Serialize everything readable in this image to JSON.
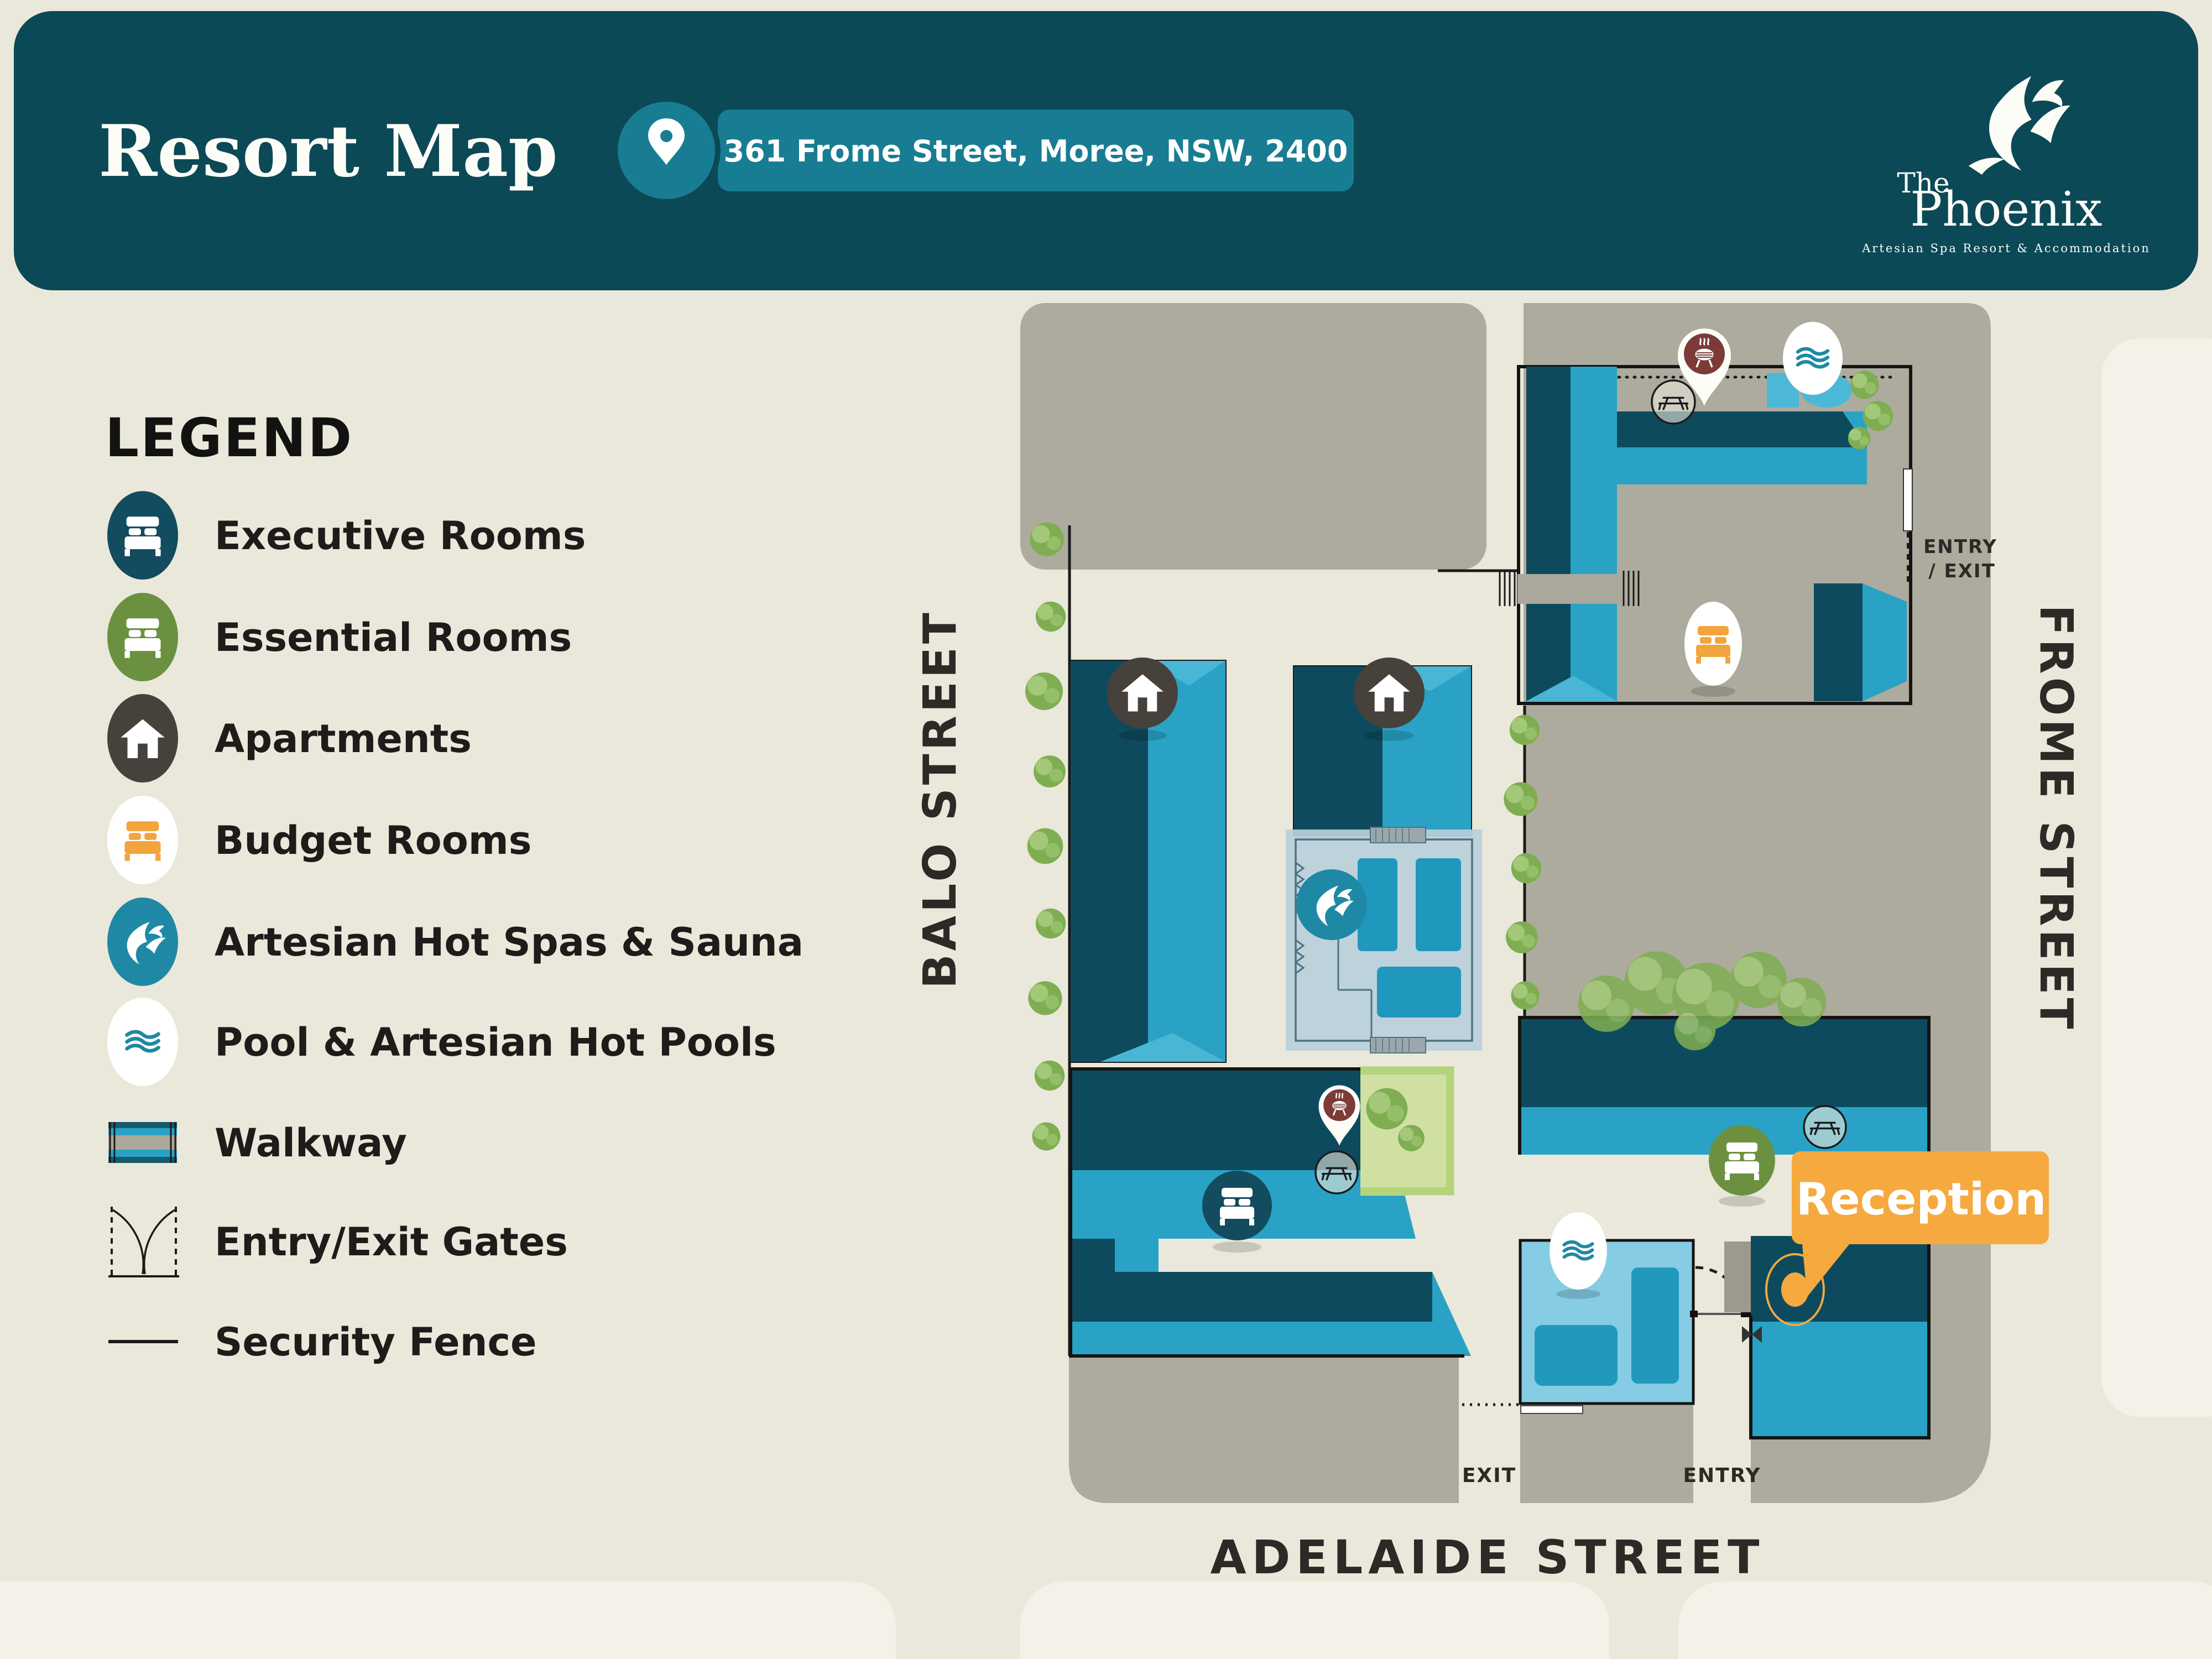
{
  "header": {
    "title": "Resort Map",
    "address": "361 Frome Street, Moree, NSW, 2400",
    "location_icon": "location-pin-icon",
    "background_color": "#0c4956",
    "badge_color": "#187d93"
  },
  "logo": {
    "brand_prefix": "The",
    "brand": "Phoenix",
    "tagline": "Artesian Spa Resort & Accommodation",
    "icon": "phoenix-icon"
  },
  "legend": {
    "title": "LEGEND",
    "items": [
      {
        "label": "Executive Rooms",
        "icon": "bed-icon",
        "color": "#134b5f"
      },
      {
        "label": "Essential Rooms",
        "icon": "bed-icon",
        "color": "#6b9140"
      },
      {
        "label": "Apartments",
        "icon": "house-icon",
        "color": "#46413b"
      },
      {
        "label": "Budget Rooms",
        "icon": "bed-icon",
        "color": "#f2a43d"
      },
      {
        "label": "Artesian Hot Spas & Sauna",
        "icon": "phoenix-icon",
        "color": "#1f89a5"
      },
      {
        "label": "Pool & Artesian Hot Pools",
        "icon": "waves-icon",
        "color": "#1f89a5"
      },
      {
        "label": "Walkway",
        "icon": "walkway-icon",
        "color": "#a9a89a"
      },
      {
        "label": "Entry/Exit Gates",
        "icon": "gate-icon",
        "color": "#1a1a1a"
      },
      {
        "label": "Security Fence",
        "icon": "fence-line-icon",
        "color": "#1a1a1a"
      }
    ]
  },
  "map": {
    "streets": {
      "west": "BALO STREET",
      "east": "FROME STREET",
      "south": "ADELAIDE STREET"
    },
    "gates": {
      "frome_gate_line1": "ENTRY",
      "frome_gate_line2": "/ EXIT",
      "adelaide_exit": "EXIT",
      "adelaide_entry": "ENTRY"
    },
    "callout": {
      "label": "Reception",
      "color": "#f5a93f"
    },
    "markers": [
      {
        "name": "apartments-marker-1",
        "icon": "house-icon"
      },
      {
        "name": "apartments-marker-2",
        "icon": "house-icon"
      },
      {
        "name": "executive-rooms-marker",
        "icon": "bed-icon"
      },
      {
        "name": "essential-rooms-marker",
        "icon": "bed-icon"
      },
      {
        "name": "budget-rooms-marker",
        "icon": "bed-icon"
      },
      {
        "name": "spa-sauna-marker",
        "icon": "phoenix-icon"
      },
      {
        "name": "pool-marker-north",
        "icon": "waves-icon"
      },
      {
        "name": "pool-marker-south",
        "icon": "waves-icon"
      },
      {
        "name": "bbq-marker-north",
        "icon": "bbq-icon"
      },
      {
        "name": "bbq-marker-south",
        "icon": "bbq-icon"
      },
      {
        "name": "picnic-marker-north",
        "icon": "picnic-table-icon"
      },
      {
        "name": "picnic-marker-central",
        "icon": "picnic-table-icon"
      },
      {
        "name": "picnic-marker-east",
        "icon": "picnic-table-icon"
      },
      {
        "name": "reception-dot",
        "icon": "dot-icon"
      }
    ],
    "colors": {
      "building_dark": "#0e4a5e",
      "building_light": "#2aa2c6",
      "driveway_grey": "#adab9e",
      "street_cream": "#eae8da",
      "block_light": "#f4f2e8",
      "lawn": "#cfe0a2",
      "pool_deck": "#85cce4",
      "pool_water": "#2398bd",
      "fence": "#1a1a1a"
    }
  }
}
